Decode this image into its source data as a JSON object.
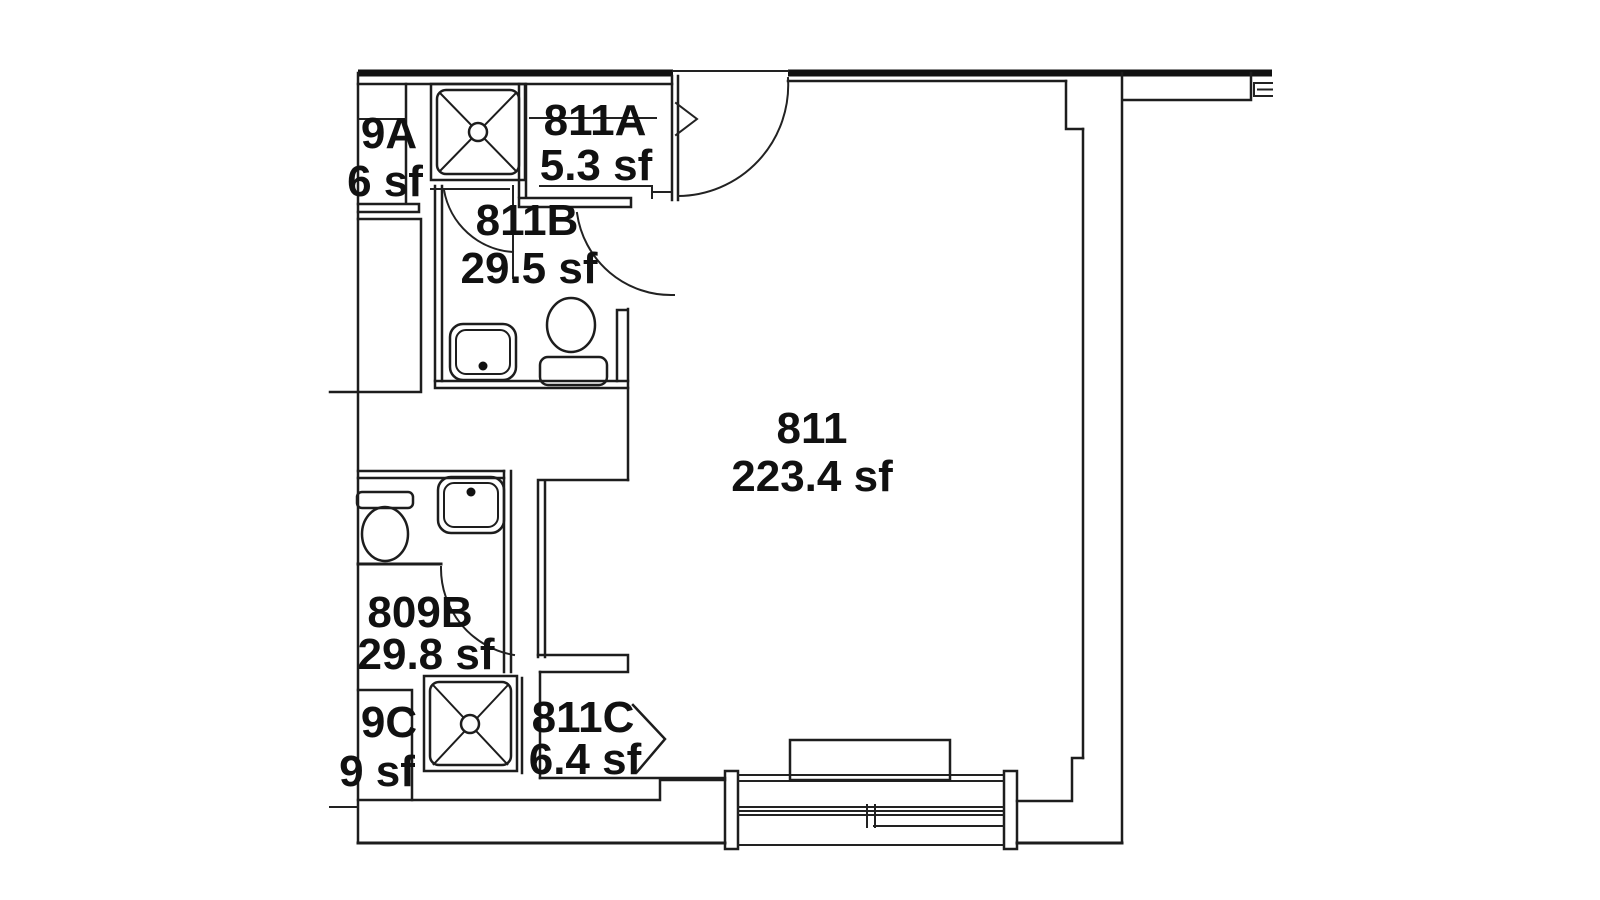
{
  "drawing": {
    "type": "architectural-floor-plan",
    "units": "sf",
    "colors": {
      "line": "#1d1d1d",
      "background": "#ffffff",
      "text": "#111111"
    },
    "rooms": {
      "r811": {
        "number": "811",
        "area": "223.4 sf"
      },
      "r811a": {
        "number": "811A",
        "area": "5.3 sf"
      },
      "r811b": {
        "number": "811B",
        "area": "29.5 sf"
      },
      "r811c": {
        "number": "811C",
        "area": "6.4 sf"
      },
      "r809a": {
        "number": "9A",
        "area": "6 sf"
      },
      "r809b": {
        "number": "809B",
        "area": "29.8 sf"
      },
      "r809c": {
        "number": "9C",
        "area": "9 sf"
      }
    },
    "fixtures": [
      "shower-icon",
      "shower-icon",
      "sink-icon",
      "sink-icon",
      "toilet-icon",
      "toilet-icon",
      "door-swing-icon",
      "door-swing-icon",
      "door-swing-icon",
      "door-swing-icon",
      "chevron-icon",
      "chevron-icon",
      "window-icon",
      "furniture-rect"
    ]
  }
}
